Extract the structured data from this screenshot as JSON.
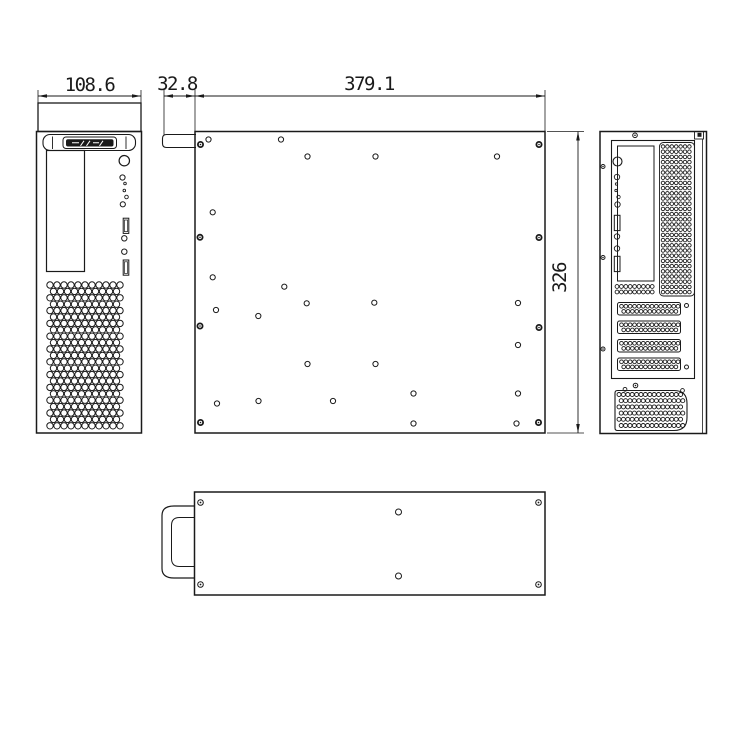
{
  "dimensions": {
    "front_width_mm": "108.6",
    "handle_depth_mm": "32.8",
    "body_length_mm": "379.1",
    "body_height_mm": "326"
  },
  "colors": {
    "line": "#1a1a1a",
    "background": "#ffffff"
  }
}
